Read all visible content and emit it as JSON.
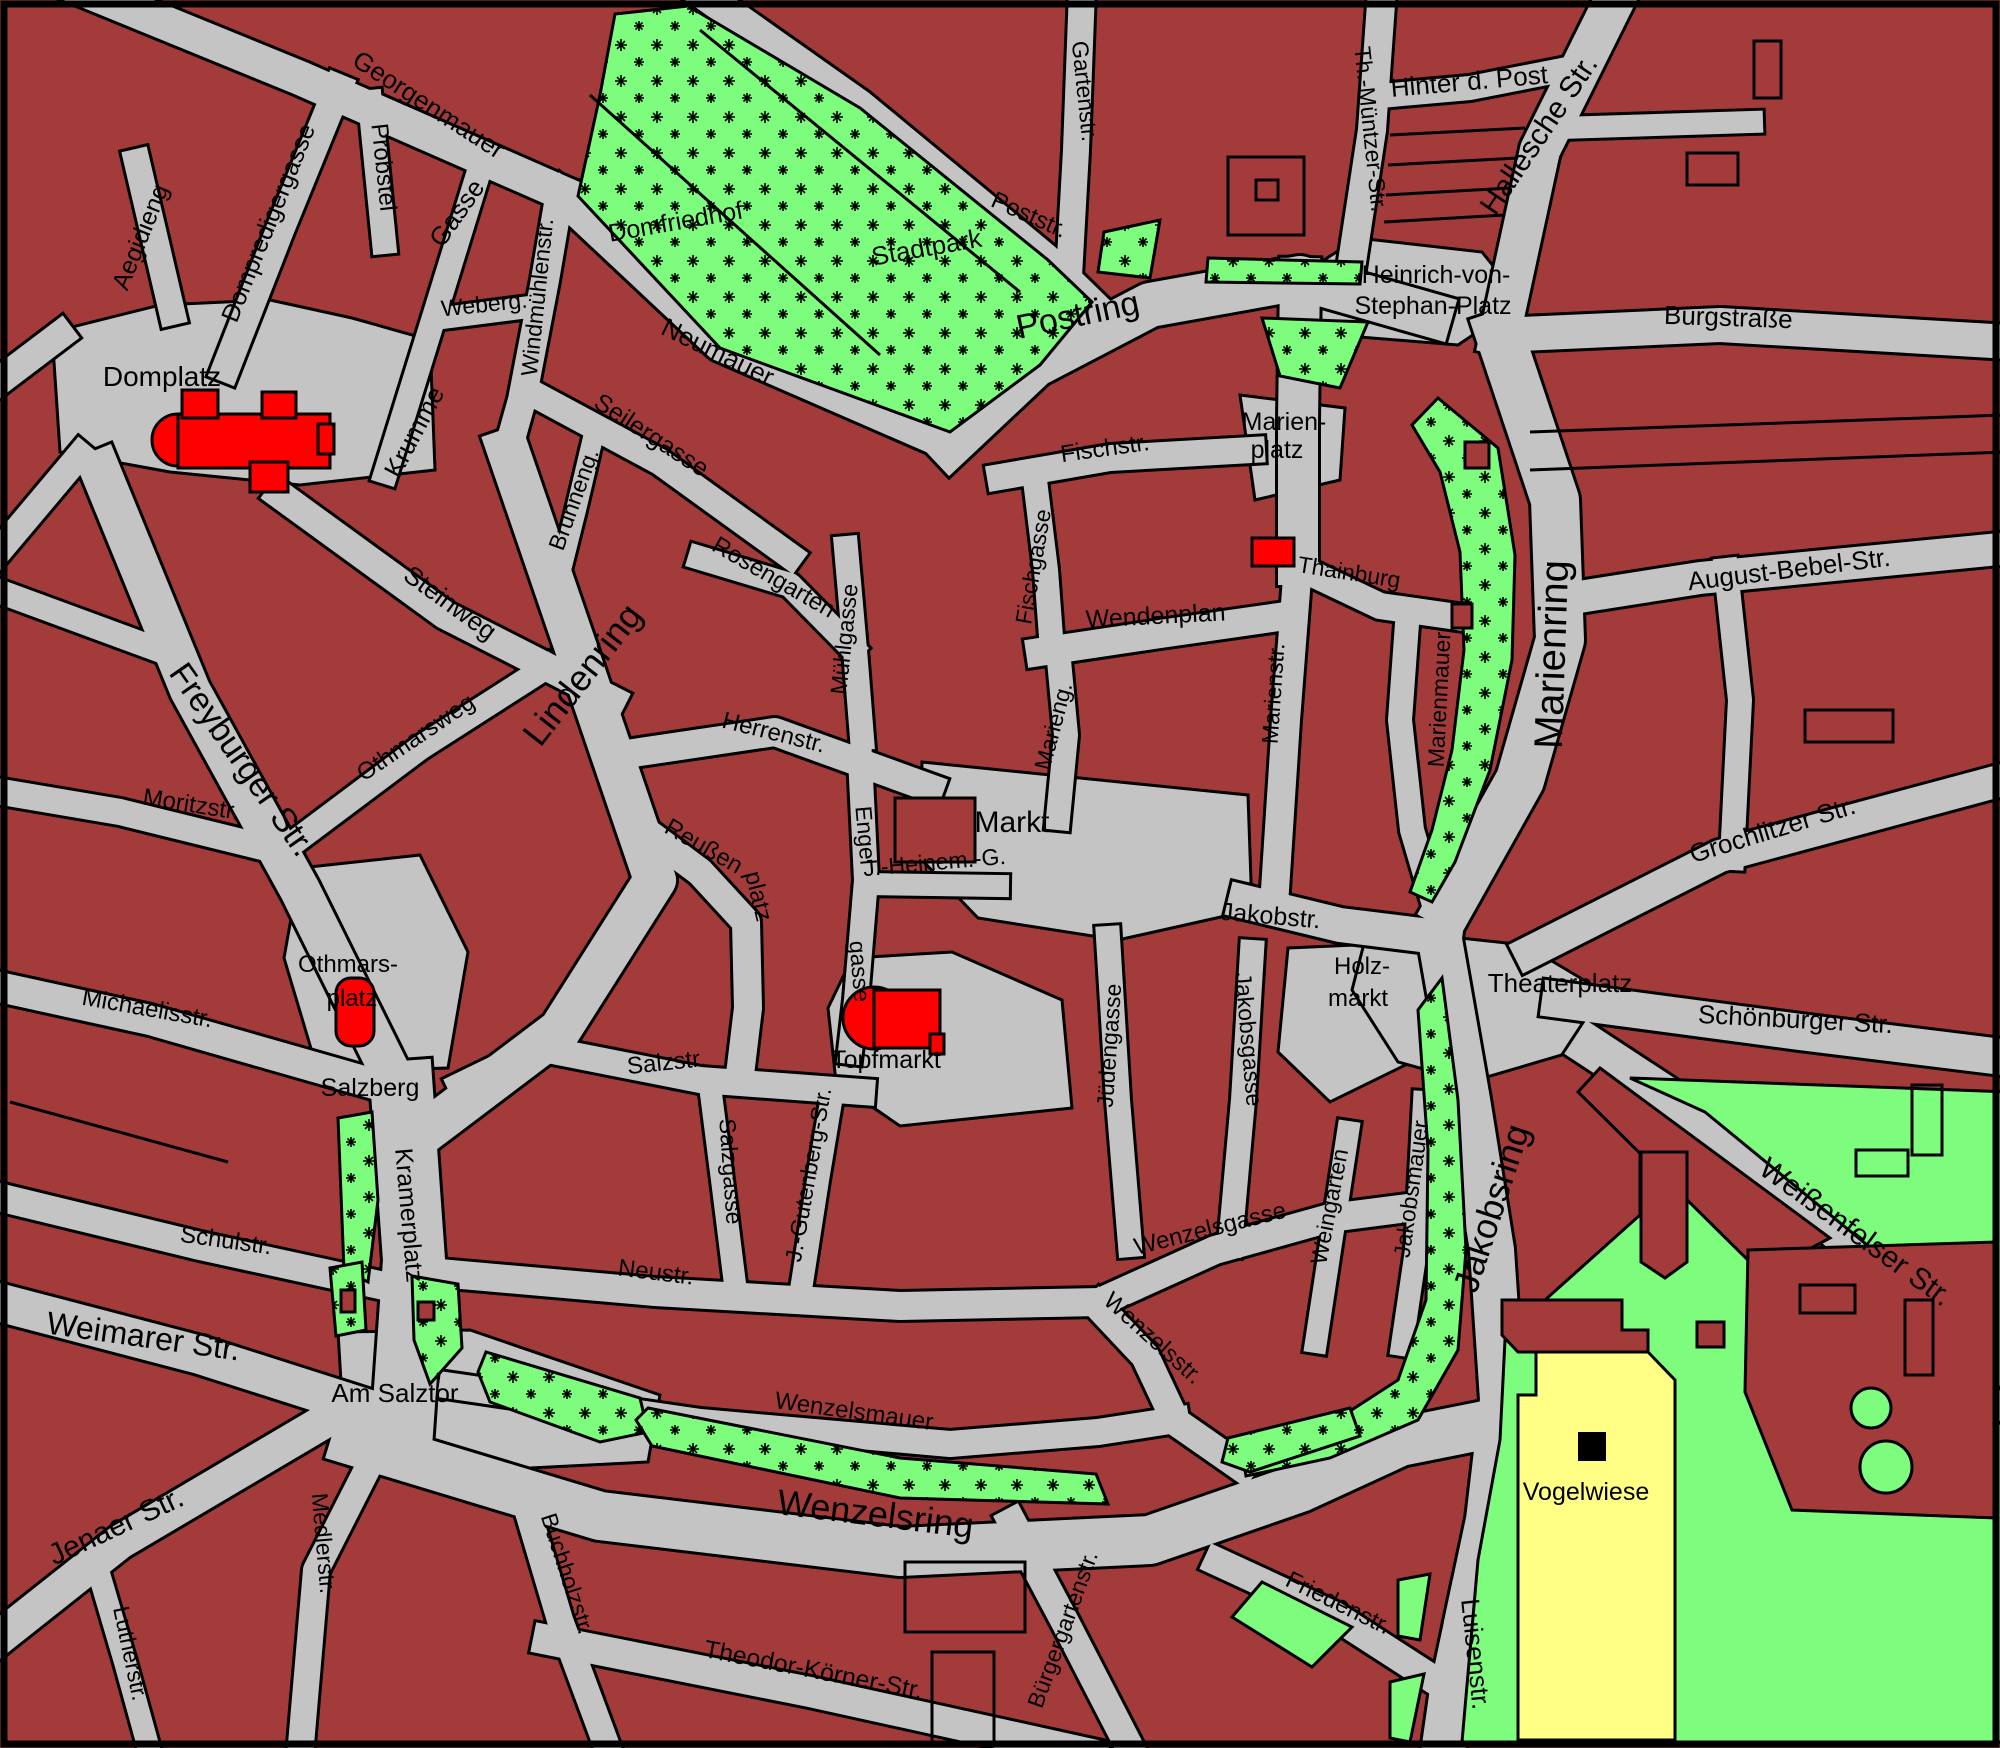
{
  "map": {
    "type": "city-street-map",
    "parking_symbol": "P",
    "colors": {
      "block": "#A33B3B",
      "street": "#C4C4C4",
      "park_green": "#7DFC7D",
      "landmark_red": "#FF0000",
      "parking_yellow": "#FFFF85",
      "outline": "#000000"
    }
  },
  "labels": [
    {
      "text": "Georgenmauer",
      "x": 424,
      "y": 112,
      "r": 33,
      "s": 26
    },
    {
      "text": "Aegidieng",
      "x": 148,
      "y": 240,
      "r": -68,
      "s": 25
    },
    {
      "text": "Dompredigergasse",
      "x": 276,
      "y": 226,
      "r": -68,
      "s": 25
    },
    {
      "text": "Probstei",
      "x": 376,
      "y": 168,
      "r": 84,
      "s": 24
    },
    {
      "text": "Gasse",
      "x": 464,
      "y": 218,
      "r": -55,
      "s": 26
    },
    {
      "text": "Krumme",
      "x": 422,
      "y": 436,
      "r": -62,
      "s": 26
    },
    {
      "text": "Weberg.",
      "x": 485,
      "y": 312,
      "r": -6,
      "s": 23
    },
    {
      "text": "Windmühlenstr.",
      "x": 545,
      "y": 298,
      "r": -84,
      "s": 23
    },
    {
      "text": "Domplatz",
      "x": 162,
      "y": 386,
      "r": 0,
      "s": 28
    },
    {
      "text": "Domfriedhof",
      "x": 677,
      "y": 230,
      "r": -10,
      "s": 25
    },
    {
      "text": "Stadtpark",
      "x": 928,
      "y": 256,
      "r": -10,
      "s": 26
    },
    {
      "text": "Neumauer",
      "x": 714,
      "y": 360,
      "r": 26,
      "s": 26
    },
    {
      "text": "Poststr.",
      "x": 1026,
      "y": 222,
      "r": 24,
      "s": 24
    },
    {
      "text": "Gartenstr.",
      "x": 1077,
      "y": 92,
      "r": 84,
      "s": 23
    },
    {
      "text": "Postring",
      "x": 1080,
      "y": 326,
      "r": -12,
      "s": 34
    },
    {
      "text": "Th.-Müntzer-Str.",
      "x": 1363,
      "y": 130,
      "r": 84,
      "s": 23
    },
    {
      "text": "Hinter d. Post",
      "x": 1470,
      "y": 90,
      "r": -5,
      "s": 26
    },
    {
      "text": "Hallesche Str.",
      "x": 1547,
      "y": 140,
      "r": -56,
      "s": 30
    },
    {
      "text": "Heinrich-von-",
      "x": 1436,
      "y": 283,
      "r": 0,
      "s": 25
    },
    {
      "text": "Stephan-Platz",
      "x": 1433,
      "y": 314,
      "r": 0,
      "s": 25
    },
    {
      "text": "Burgstraße",
      "x": 1728,
      "y": 326,
      "r": 2,
      "s": 26
    },
    {
      "text": "Seilergasse",
      "x": 647,
      "y": 442,
      "r": 33,
      "s": 25
    },
    {
      "text": "Brunneng.",
      "x": 581,
      "y": 502,
      "r": -70,
      "s": 23
    },
    {
      "text": "Lindenring",
      "x": 592,
      "y": 682,
      "r": -52,
      "s": 36
    },
    {
      "text": "Steinweg",
      "x": 445,
      "y": 610,
      "r": 36,
      "s": 26
    },
    {
      "text": "Othmarsweg",
      "x": 420,
      "y": 744,
      "r": -34,
      "s": 24
    },
    {
      "text": "Rosengarten",
      "x": 770,
      "y": 584,
      "r": 30,
      "s": 24
    },
    {
      "text": "Mühlgasse",
      "x": 852,
      "y": 640,
      "r": -84,
      "s": 23
    },
    {
      "text": "Fischgasse",
      "x": 1041,
      "y": 568,
      "r": -80,
      "s": 23
    },
    {
      "text": "Fischstr.",
      "x": 1106,
      "y": 456,
      "r": -8,
      "s": 24
    },
    {
      "text": "Herrenstr.",
      "x": 772,
      "y": 740,
      "r": 14,
      "s": 24
    },
    {
      "text": "Marien-",
      "x": 1284,
      "y": 430,
      "r": 0,
      "s": 25
    },
    {
      "text": "platz",
      "x": 1277,
      "y": 458,
      "r": 0,
      "s": 25
    },
    {
      "text": "Thainburg",
      "x": 1348,
      "y": 580,
      "r": 9,
      "s": 23
    },
    {
      "text": "Wendenplan",
      "x": 1156,
      "y": 624,
      "r": -3,
      "s": 25
    },
    {
      "text": "Marieng.",
      "x": 1061,
      "y": 728,
      "r": -75,
      "s": 23
    },
    {
      "text": "Marienstr.",
      "x": 1281,
      "y": 694,
      "r": -86,
      "s": 23
    },
    {
      "text": "Marienmauer",
      "x": 1447,
      "y": 700,
      "r": -87,
      "s": 23
    },
    {
      "text": "Marienring",
      "x": 1565,
      "y": 655,
      "r": -88,
      "s": 40
    },
    {
      "text": "August-Bebel-Str.",
      "x": 1790,
      "y": 578,
      "r": -7,
      "s": 26
    },
    {
      "text": "Grochlitzer Str.",
      "x": 1775,
      "y": 838,
      "r": -17,
      "s": 26
    },
    {
      "text": "Theaterplatz",
      "x": 1560,
      "y": 992,
      "r": 0,
      "s": 26
    },
    {
      "text": "Schönburger Str.",
      "x": 1795,
      "y": 1028,
      "r": 3,
      "s": 26
    },
    {
      "text": "Weißenfelser Str.",
      "x": 1850,
      "y": 1240,
      "r": 36,
      "s": 30
    },
    {
      "text": "Freyburger Str.",
      "x": 233,
      "y": 766,
      "r": 55,
      "s": 34
    },
    {
      "text": "Moritzstr.",
      "x": 190,
      "y": 812,
      "r": 9,
      "s": 24
    },
    {
      "text": "Michaelisstr.",
      "x": 146,
      "y": 1016,
      "r": 10,
      "s": 24
    },
    {
      "text": "Othmars-",
      "x": 348,
      "y": 972,
      "r": 0,
      "s": 24
    },
    {
      "text": "platz",
      "x": 352,
      "y": 1006,
      "r": 0,
      "s": 24
    },
    {
      "text": "Salzberg",
      "x": 370,
      "y": 1096,
      "r": 0,
      "s": 25
    },
    {
      "text": "Reußen",
      "x": 700,
      "y": 853,
      "r": 30,
      "s": 24
    },
    {
      "text": "platz",
      "x": 751,
      "y": 898,
      "r": 76,
      "s": 24
    },
    {
      "text": "Markt",
      "x": 1012,
      "y": 832,
      "r": 0,
      "s": 30
    },
    {
      "text": "J.-Heinem.-G.",
      "x": 935,
      "y": 870,
      "r": -5,
      "s": 23
    },
    {
      "text": "Engel",
      "x": 858,
      "y": 836,
      "r": 85,
      "s": 23
    },
    {
      "text": "gasse",
      "x": 852,
      "y": 972,
      "r": 85,
      "s": 23
    },
    {
      "text": "Jüdengasse",
      "x": 1117,
      "y": 1046,
      "r": -86,
      "s": 23
    },
    {
      "text": "Jakobstr.",
      "x": 1270,
      "y": 924,
      "r": 5,
      "s": 25
    },
    {
      "text": "Holz-",
      "x": 1362,
      "y": 974,
      "r": 0,
      "s": 24
    },
    {
      "text": "markt",
      "x": 1358,
      "y": 1006,
      "r": 0,
      "s": 24
    },
    {
      "text": "Jakobsgasse",
      "x": 1241,
      "y": 1040,
      "r": 85,
      "s": 23
    },
    {
      "text": "Weingarten",
      "x": 1337,
      "y": 1208,
      "r": -79,
      "s": 23
    },
    {
      "text": "Jakobsmauer",
      "x": 1419,
      "y": 1190,
      "r": -82,
      "s": 23
    },
    {
      "text": "Jakobsring",
      "x": 1503,
      "y": 1212,
      "r": -72,
      "s": 36
    },
    {
      "text": "Salzstr.",
      "x": 667,
      "y": 1070,
      "r": -6,
      "s": 24
    },
    {
      "text": "Topfmarkt",
      "x": 886,
      "y": 1068,
      "r": 0,
      "s": 25
    },
    {
      "text": "Salzgasse",
      "x": 723,
      "y": 1172,
      "r": 86,
      "s": 23
    },
    {
      "text": "J.-Gutenberg-Str.",
      "x": 816,
      "y": 1176,
      "r": -80,
      "s": 23
    },
    {
      "text": "Neustr.",
      "x": 655,
      "y": 1280,
      "r": 7,
      "s": 24
    },
    {
      "text": "Wenzelsgasse",
      "x": 1212,
      "y": 1236,
      "r": -14,
      "s": 24
    },
    {
      "text": "Wenzelsstr.",
      "x": 1148,
      "y": 1344,
      "r": 42,
      "s": 24
    },
    {
      "text": "Wenzelsmauer",
      "x": 853,
      "y": 1419,
      "r": 8,
      "s": 24
    },
    {
      "text": "Wenzelsring",
      "x": 874,
      "y": 1526,
      "r": 7,
      "s": 36
    },
    {
      "text": "Kramerplatz",
      "x": 401,
      "y": 1216,
      "r": 85,
      "s": 25
    },
    {
      "text": "Schulstr.",
      "x": 225,
      "y": 1248,
      "r": 8,
      "s": 24
    },
    {
      "text": "Weimarer Str.",
      "x": 142,
      "y": 1347,
      "r": 8,
      "s": 32
    },
    {
      "text": "Am Salztor",
      "x": 395,
      "y": 1402,
      "r": 0,
      "s": 26
    },
    {
      "text": "Jenaer Str.",
      "x": 120,
      "y": 1535,
      "r": -25,
      "s": 30
    },
    {
      "text": "Lutherstr.",
      "x": 123,
      "y": 1655,
      "r": 78,
      "s": 23
    },
    {
      "text": "Medlerstr.",
      "x": 316,
      "y": 1544,
      "r": 85,
      "s": 23
    },
    {
      "text": "Buchholzstr.",
      "x": 560,
      "y": 1576,
      "r": 72,
      "s": 23
    },
    {
      "text": "Theodor-Körner-Str.",
      "x": 812,
      "y": 1678,
      "r": 11,
      "s": 25
    },
    {
      "text": "Bürgergartenstr.",
      "x": 1070,
      "y": 1632,
      "r": -70,
      "s": 23
    },
    {
      "text": "Friedenstr.",
      "x": 1335,
      "y": 1610,
      "r": 26,
      "s": 24
    },
    {
      "text": "Luisenstr.",
      "x": 1467,
      "y": 1655,
      "r": 84,
      "s": 26
    },
    {
      "text": "Vogelwiese",
      "x": 1586,
      "y": 1500,
      "r": 0,
      "s": 25
    }
  ],
  "streets": [
    {
      "d": "M60,-20 L300,78 L560,192",
      "w": 34
    },
    {
      "d": "M560,195 L720,345 L950,445",
      "w": 32
    },
    {
      "d": "M950,445 L1035,365 L1150,305 L1300,278 L1430,315",
      "w": 44
    },
    {
      "d": "M1622,-15 L1540,150 L1500,335",
      "w": 40
    },
    {
      "d": "M1500,335 L1720,325 L2010,342",
      "w": 34
    },
    {
      "d": "M1500,335 L1555,500 L1560,640 L1520,780 L1450,905",
      "w": 48
    },
    {
      "d": "M1560,1000 L1800,1032 L2010,1058",
      "w": 36
    },
    {
      "d": "M1530,952 L1720,856 L2010,778",
      "w": 32
    },
    {
      "d": "M1592,1048 L1720,1132 L1900,1282 L2022,1422",
      "w": 40
    },
    {
      "d": "M1440,940 L1468,1100 L1492,1250 L1502,1400 L1488,1520 L1470,1605",
      "w": 44
    },
    {
      "d": "M1470,1605 L1452,1690 L1442,1760",
      "w": 44
    },
    {
      "d": "M355,1442 L600,1516 L900,1552 L1150,1540 L1300,1488 L1400,1442 L1470,1428",
      "w": 48
    },
    {
      "d": "M402,1092 L414,1260 L402,1432",
      "w": 62
    },
    {
      "d": "M508,450 L580,660 L655,880 L560,1030 L425,1132",
      "w": 42
    },
    {
      "d": "M100,470 L190,690 L300,890 L398,1088",
      "w": 40
    },
    {
      "d": "M-10,1300 L200,1355 L410,1422",
      "w": 38
    },
    {
      "d": "M330,1418 L120,1542 L-10,1645",
      "w": 34
    },
    {
      "d": "M-10,1195 L200,1246 L375,1284",
      "w": 28
    },
    {
      "d": "M-10,985 L150,1020 L395,1090",
      "w": 30
    },
    {
      "d": "M-10,790 L120,812 L258,846",
      "w": 26
    },
    {
      "d": "M280,495 L445,615 L612,700",
      "w": 28
    },
    {
      "d": "M300,838 L420,748 L545,668",
      "w": 24
    },
    {
      "d": "M560,192 L545,280 L522,400 L508,450",
      "w": 28
    },
    {
      "d": "M530,392 L660,462 L790,556",
      "w": 26
    },
    {
      "d": "M592,442 L576,510 L560,574",
      "w": 20
    },
    {
      "d": "M700,558 L790,585 L852,648",
      "w": 24
    },
    {
      "d": "M846,548 L855,650 L862,738",
      "w": 24
    },
    {
      "d": "M640,752 L775,732 L930,788",
      "w": 28
    },
    {
      "d": "M637,825 L700,872 L746,922 L748,1008 L742,1058",
      "w": 28
    },
    {
      "d": "M860,758 L866,880 L856,1000 L850,1052",
      "w": 24
    },
    {
      "d": "M866,884 L998,886",
      "w": 22
    },
    {
      "d": "M1058,650 L1066,735 L1058,818",
      "w": 24
    },
    {
      "d": "M1034,472 L1046,570 L1052,650",
      "w": 24
    },
    {
      "d": "M1000,477 L1110,458 L1252,450",
      "w": 26
    },
    {
      "d": "M1040,652 L1160,634 L1272,618",
      "w": 28
    },
    {
      "d": "M690,-15 L860,105 L1045,258 L1090,302",
      "w": 30
    },
    {
      "d": "M1082,-10 L1076,150 L1066,330",
      "w": 26
    },
    {
      "d": "M1382,-10 L1372,130 L1352,262",
      "w": 28
    },
    {
      "d": "M1380,96 L1470,88 L1562,70",
      "w": 24
    },
    {
      "d": "M1300,278 L1298,420 L1298,565",
      "w": 40
    },
    {
      "d": "M1298,565 L1286,720 L1274,905",
      "w": 28
    },
    {
      "d": "M1300,568 L1380,606 L1492,622",
      "w": 26
    },
    {
      "d": "M1408,610 L1400,720 L1412,830 L1432,898",
      "w": 24
    },
    {
      "d": "M1560,600 L1700,578 L2010,548",
      "w": 32
    },
    {
      "d": "M1726,570 L1740,700 L1732,858",
      "w": 24
    },
    {
      "d": "M1245,902 L1340,925 L1445,938",
      "w": 34
    },
    {
      "d": "M1108,938 L1118,1100 L1130,1245",
      "w": 24
    },
    {
      "d": "M1252,952 L1243,1100 L1230,1245",
      "w": 24
    },
    {
      "d": "M1100,1302 L1215,1250 L1330,1218 L1408,1208",
      "w": 28
    },
    {
      "d": "M1348,1132 L1330,1250 L1316,1342",
      "w": 22
    },
    {
      "d": "M1424,1102 L1416,1250 L1402,1345",
      "w": 22
    },
    {
      "d": "M1098,1306 L1145,1356 L1176,1422 L1242,1468",
      "w": 28
    },
    {
      "d": "M428,1272 L655,1292 L900,1306 L1100,1302",
      "w": 28
    },
    {
      "d": "M548,1050 L700,1080 L862,1092",
      "w": 26
    },
    {
      "d": "M710,1086 L722,1180 L736,1292",
      "w": 22
    },
    {
      "d": "M832,1096 L818,1180 L800,1296",
      "w": 22
    },
    {
      "d": "M452,1386 L700,1422 L950,1444 L1098,1432 L1176,1420",
      "w": 26
    },
    {
      "d": "M382,1440 L316,1570 L300,1756",
      "w": 26
    },
    {
      "d": "M95,1560 L125,1662 L152,1760",
      "w": 22
    },
    {
      "d": "M522,1492 L560,1620 L612,1760",
      "w": 26
    },
    {
      "d": "M548,1640 L810,1692 L1092,1754",
      "w": 30
    },
    {
      "d": "M1012,1522 L1065,1622 L1132,1752",
      "w": 28
    },
    {
      "d": "M1218,1562 L1335,1616 L1462,1698",
      "w": 28
    },
    {
      "d": "M137,162 L172,312",
      "w": 26
    },
    {
      "d": "M338,88 L280,230 L226,368",
      "w": 28
    },
    {
      "d": "M370,102 L384,242",
      "w": 24
    },
    {
      "d": "M480,168 L430,330 L386,472",
      "w": 24
    },
    {
      "d": "M443,318 L537,306",
      "w": 22
    },
    {
      "d": "M60,335 L-10,388",
      "w": 28
    },
    {
      "d": "M80,455 L-10,562",
      "w": 26
    },
    {
      "d": "M-10,588 L172,655",
      "w": 24
    },
    {
      "d": "M1560,128 L1752,122",
      "w": 22
    },
    {
      "d": "M540,1048 L462,1086",
      "w": 28
    }
  ],
  "plazas": [
    "52,332 160,305 270,300 352,318 430,340 435,470 300,485 170,472 60,452",
    "300,868 420,855 468,952 448,1068 318,1072 284,958",
    "922,762 1248,795 1252,910 1118,940 978,918 920,858",
    "828,1008 852,958 952,952 1062,1000 1072,1108 900,1126 836,1082",
    "1288,948 1425,942 1436,1050 1330,1102 1278,1052",
    "1368,928 1525,945 1604,992 1572,1052 1470,1082 1398,1062 1352,990",
    "1358,238 1482,252 1522,302 1458,345 1298,332 1290,282",
    "338,1332 470,1330 660,1395 648,1462 452,1472 344,1432",
    "1240,395 1345,408 1340,480 1255,500"
  ],
  "greens_starred": [
    "615,14 688,6 860,108 1048,260 1092,302 1040,365 950,432 720,348 578,196 600,95",
    "1104,232 1160,220 1150,278 1098,272",
    "1208,258 1362,262 1360,284 1206,282",
    "1262,318 1368,322 1340,388 1280,376",
    "1438,398 1498,448 1515,555 1512,660 1490,770 1455,862 1432,902 1410,892 1432,830 1452,750 1464,650 1460,552 1440,472 1412,425",
    "1442,978 1458,1100 1466,1250 1458,1350 1418,1420 1330,1458 1246,1476 1240,1442 1330,1424 1398,1380 1426,1300 1428,1150 1418,1010",
    "338,1118 372,1112 378,1200 368,1282 344,1270",
    "330,1268 362,1262 366,1330 336,1336",
    "412,1276 458,1284 462,1348 430,1384 414,1340",
    "486,1352 640,1398 648,1432 600,1442 490,1402 478,1372",
    "648,1408 900,1458 1096,1474 1108,1504 900,1498 652,1446 636,1420",
    "1228,1438 1350,1408 1360,1436 1250,1472 1222,1462"
  ],
  "greens_plain": [
    "1640,1130 1830,1270 2010,1432 2010,1742 1462,1742 1478,1560 1500,1440 1505,1340 1545,1300 1640,1215",
    "1630,1078 2010,1092 2010,1400 1900,1272 1705,1112",
    "1262,1582 1352,1627 1312,1667 1232,1617",
    "1398,1580 1430,1574 1420,1640 1398,1636",
    "1390,1682 1424,1674 1410,1742 1390,1738"
  ],
  "red_overlays": [
    "1600,1068 1830,1238 1762,1274 1578,1092",
    "1748,1250 1995,1242 1995,1518 1792,1510 1745,1392",
    "1502,1300 1622,1300 1622,1330 1648,1330 1648,1352 1518,1352 1502,1335",
    "1641,1152 1687,1152 1687,1262 1665,1278 1641,1262",
    "1697,1322 1724,1322 1724,1347 1697,1347",
    "341,1290 355,1290 355,1312 341,1312",
    "418,1302 434,1302 434,1320 418,1320",
    "1465,442 1489,442 1489,468 1465,468",
    "1452,604 1472,604 1472,628 1452,628"
  ],
  "tree_circles": [
    {
      "cx": 1871,
      "cy": 1408,
      "r": 20
    },
    {
      "cx": 1886,
      "cy": 1467,
      "r": 26
    }
  ],
  "vogelwiese_poly": "1518,1395 1536,1395 1536,1352 1648,1352 1675,1380 1675,1740 1518,1740",
  "parking_box": {
    "x": 1578,
    "y": 1432,
    "w": 28,
    "h": 29
  },
  "landmarks": {
    "dom": [
      {
        "type": "circle",
        "cx": 178,
        "cy": 440,
        "r": 26
      },
      {
        "type": "rect",
        "x": 178,
        "y": 414,
        "w": 152,
        "h": 54
      },
      {
        "type": "rect",
        "x": 182,
        "y": 390,
        "w": 36,
        "h": 28
      },
      {
        "type": "rect",
        "x": 262,
        "y": 392,
        "w": 34,
        "h": 26
      },
      {
        "type": "rect",
        "x": 318,
        "y": 424,
        "w": 16,
        "h": 30
      },
      {
        "type": "rect",
        "x": 250,
        "y": 462,
        "w": 38,
        "h": 30
      }
    ],
    "othmars_chapel": {
      "x": 336,
      "y": 978,
      "w": 38,
      "h": 68,
      "rx": 15
    },
    "wenzelskirche": [
      {
        "type": "circle",
        "cx": 874,
        "cy": 1018,
        "r": 31
      },
      {
        "type": "rect",
        "x": 874,
        "y": 990,
        "w": 66,
        "h": 58
      },
      {
        "type": "rect",
        "x": 930,
        "y": 1034,
        "w": 14,
        "h": 20
      }
    ],
    "thainburg_rect": {
      "x": 1252,
      "y": 538,
      "w": 42,
      "h": 28
    },
    "markt_block": {
      "x": 895,
      "y": 798,
      "w": 80,
      "h": 64
    }
  },
  "detail_lines": [
    "M1390,135 L1525,128",
    "M1388,165 L1518,158",
    "M1386,195 L1510,188",
    "M1384,222 L1505,215",
    "M1530,432 L2005,415",
    "M1530,470 L2005,452",
    "M10,1102 L228,1162",
    "M590,95 L880,355",
    "M700,30 L1020,292"
  ],
  "detail_rects": [
    {
      "x": 1228,
      "y": 157,
      "w": 76,
      "h": 78
    },
    {
      "x": 1256,
      "y": 180,
      "w": 22,
      "h": 20
    },
    {
      "x": 1754,
      "y": 41,
      "w": 27,
      "h": 57
    },
    {
      "x": 1687,
      "y": 153,
      "w": 51,
      "h": 32
    },
    {
      "x": 1805,
      "y": 710,
      "w": 88,
      "h": 32
    },
    {
      "x": 1800,
      "y": 1285,
      "w": 55,
      "h": 28
    },
    {
      "x": 1905,
      "y": 1300,
      "w": 28,
      "h": 75
    },
    {
      "x": 905,
      "y": 1562,
      "w": 120,
      "h": 70
    },
    {
      "x": 932,
      "y": 1652,
      "w": 62,
      "h": 94
    },
    {
      "x": 1856,
      "y": 1150,
      "w": 52,
      "h": 26
    },
    {
      "x": 1912,
      "y": 1085,
      "w": 30,
      "h": 70
    }
  ]
}
